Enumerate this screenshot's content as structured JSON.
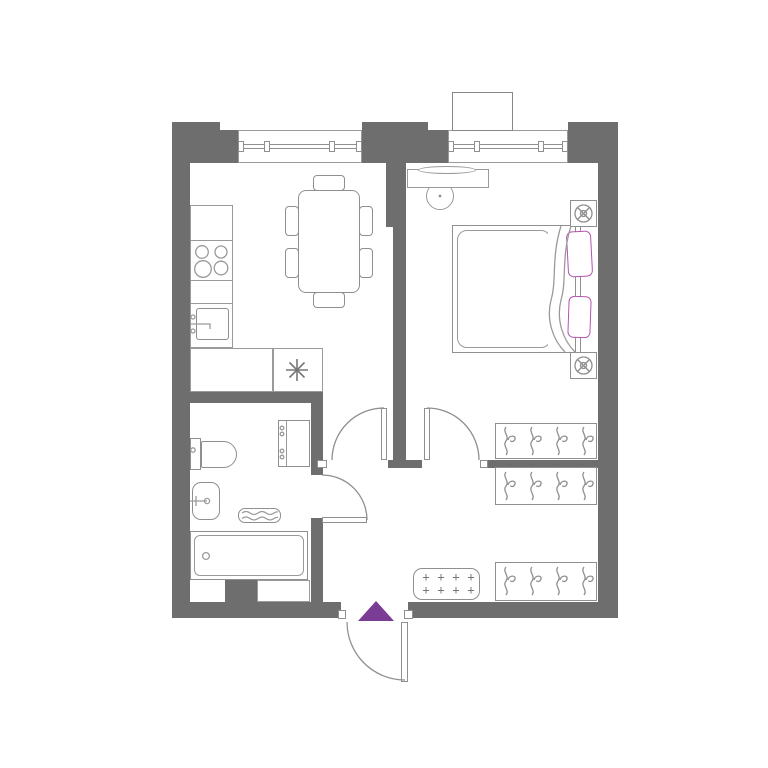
{
  "colors": {
    "background": "#ffffff",
    "wall": "#6e6e6e",
    "line": "#8f8f8f",
    "line_light": "#9a9a9a",
    "accent_purple": "#7b3c96",
    "pillow_magenta": "#b454ae",
    "symbol_gray": "#777777"
  },
  "symbols": {
    "appliance_star": "✳",
    "doormat_plus": "+",
    "entrance_marker": "purple-triangle"
  },
  "plan": {
    "rooms": [
      "kitchen-living-room",
      "bedroom",
      "bathroom",
      "hall"
    ],
    "window_count": 2,
    "doors": [
      "living-room-door",
      "bedroom-door",
      "bathroom-door",
      "entrance-door"
    ],
    "kitchen": {
      "hob_burners": 4,
      "items": [
        "worktop",
        "hob",
        "sink",
        "appliance-with-star-symbol"
      ]
    },
    "dining": {
      "tables": 1,
      "chairs": 6
    },
    "bedroom": {
      "items": [
        "console-with-mirror",
        "stool",
        "double-bed",
        "pillows",
        "nightstands",
        "lamp-symbols",
        "wardrobe"
      ],
      "pillow_count": 2,
      "nightstand_count": 2
    },
    "bathroom": {
      "items": [
        "toilet",
        "washbasin",
        "towel-radiator",
        "bathtub",
        "tall-cabinet"
      ]
    },
    "hall": {
      "items": [
        "wardrobe",
        "wardrobe",
        "doormat"
      ],
      "doormat_plus_count": 8
    },
    "wardrobes": {
      "count": 3,
      "hangers_each": 4
    }
  }
}
